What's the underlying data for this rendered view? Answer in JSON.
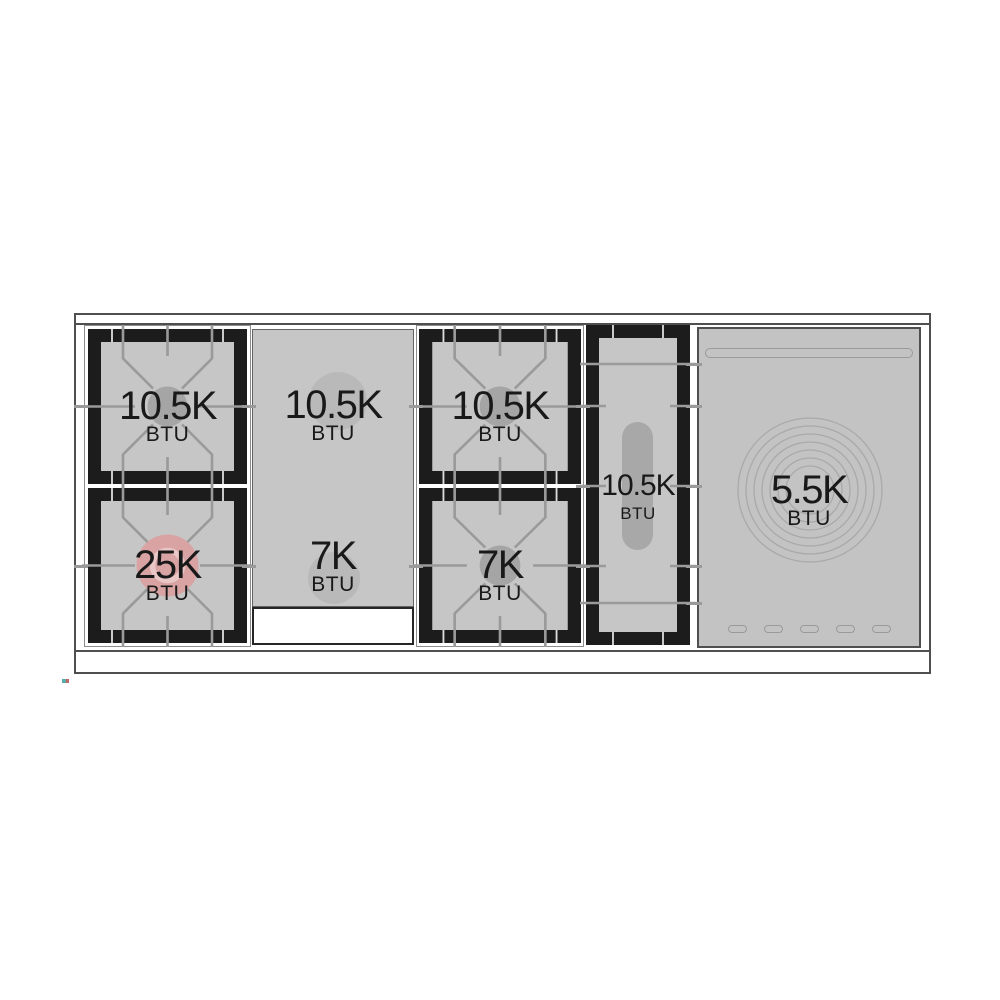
{
  "diagram": {
    "name": "Rangetop burner layout with BTU ratings",
    "colors": {
      "surface_gray": "#c6c6c6",
      "panel_gray": "#c3c3c3",
      "grate_black": "#1c1c1c",
      "line_gray": "#9a9a9a",
      "outline_dark": "#4f4f4f",
      "outline_light": "#8c8c8c",
      "cap_gray": "#a5a5a5",
      "ghost_gray": "#b9b9b9",
      "highlight_pink": "#d9a3a3",
      "highlight_pink_light": "#eac7c7",
      "text_dark": "#191919"
    },
    "burners": {
      "left_rear": {
        "value": "10.5K",
        "unit": "BTU"
      },
      "left_front": {
        "value": "25K",
        "unit": "BTU",
        "highlighted": true
      },
      "griddle_rear": {
        "value": "10.5K",
        "unit": "BTU"
      },
      "griddle_front": {
        "value": "7K",
        "unit": "BTU"
      },
      "center_rear": {
        "value": "10.5K",
        "unit": "BTU"
      },
      "center_front": {
        "value": "7K",
        "unit": "BTU"
      },
      "oval": {
        "value": "10.5K",
        "unit": "BTU"
      },
      "simmer": {
        "value": "5.5K",
        "unit": "BTU"
      }
    }
  }
}
